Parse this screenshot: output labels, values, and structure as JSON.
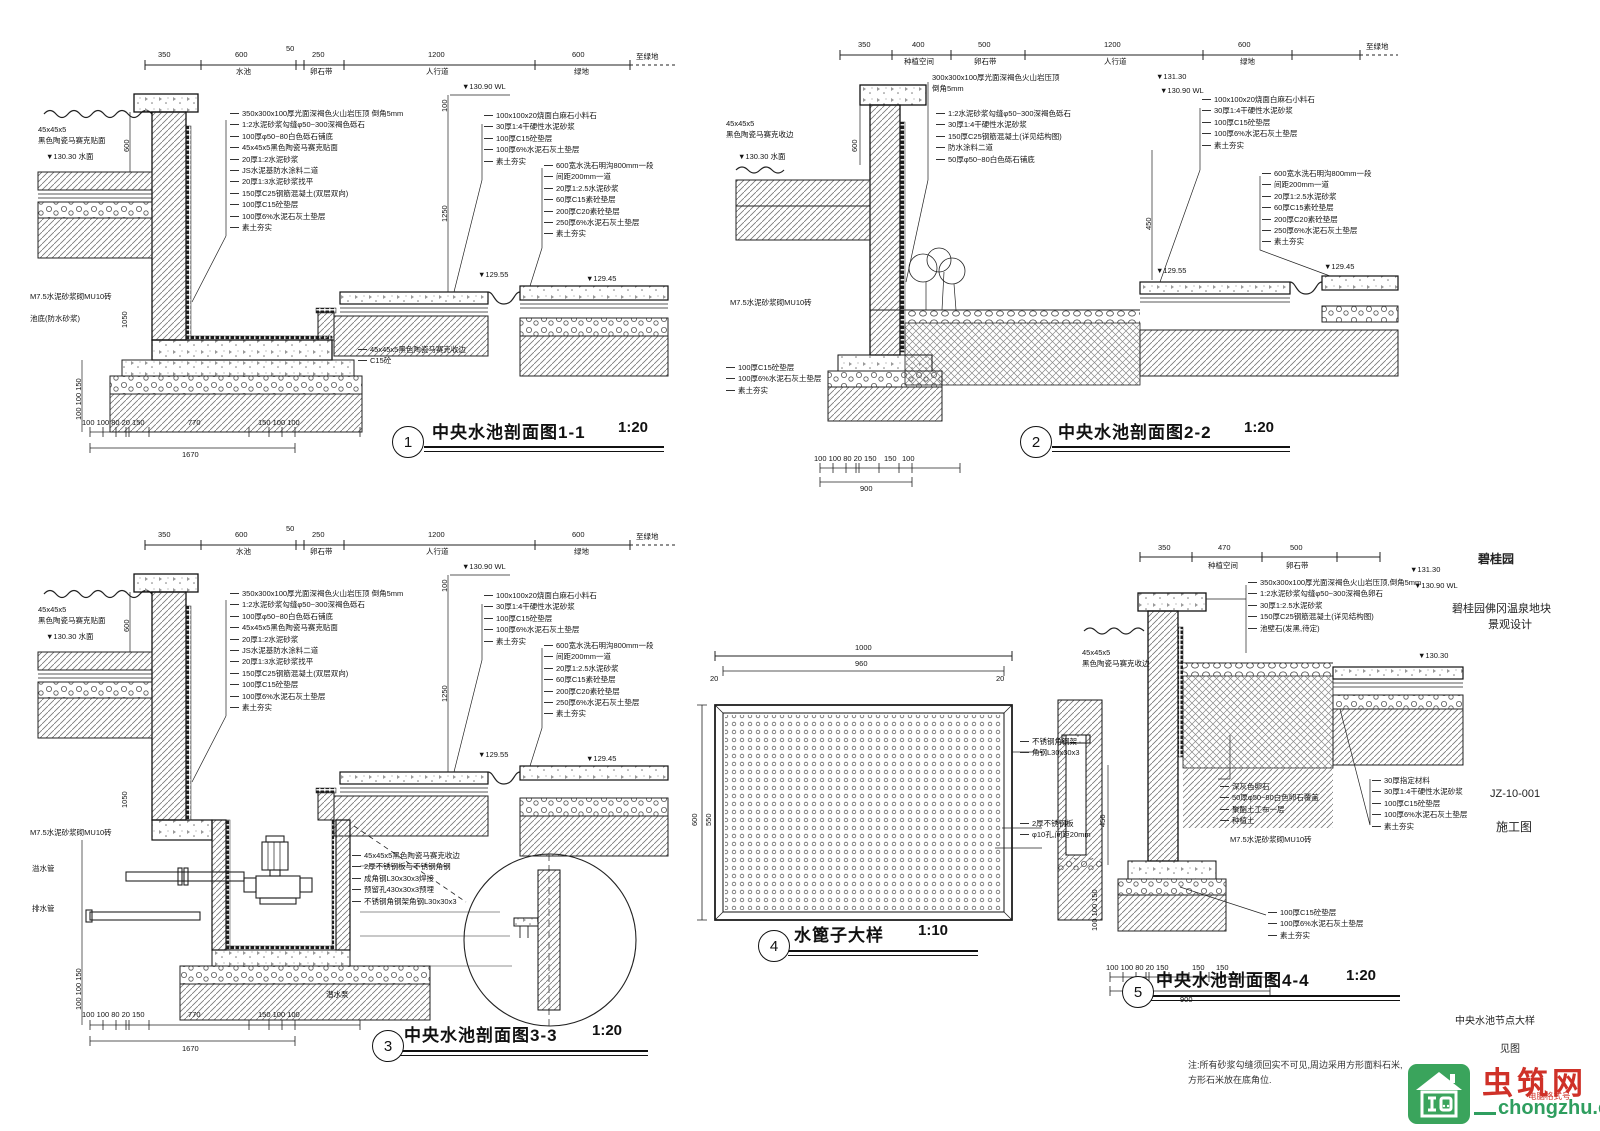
{
  "details": {
    "d1": {
      "num": "1",
      "name": "中央水池剖面图1-1",
      "scale": "1:20",
      "dims_top": [
        "350",
        "600",
        "50",
        "250",
        "1200",
        "600"
      ],
      "seg_labels": [
        "水池",
        "卵石带",
        "人行道",
        "绿地"
      ],
      "tail": "至绿地",
      "elev_wl": "▼130.90 WL",
      "elev_water": "▼130.30 水面",
      "elev_p1": "▼129.55",
      "elev_p2": "▼129.45",
      "v600": "600",
      "v100": "100",
      "v1250": "1250",
      "v1050": "1050",
      "vstack": "100 100 150",
      "notes_left": [
        "45x45x5",
        "黑色陶瓷马赛克贴面"
      ],
      "note_m75": "M7.5水泥砂浆砌MU10砖",
      "note_pool_bottom": "池底(防水砂浆)",
      "notes_center": [
        "350x300x100厚光面深褐色火山岩压顶 倒角5mm",
        "1:2水泥砂浆勾缝φ50~300深褐色砾石",
        "100厚φ50~80白色砾石铺底",
        "45x45x5黑色陶瓷马赛克贴面",
        "20厚1:2水泥砂浆",
        "JS水泥基防水涂料二道",
        "20厚1:3水泥砂浆找平",
        "150厚C25钢筋混凝土(双层双向)",
        "100厚C15砼垫层",
        "100厚6%水泥石灰土垫层",
        "素土夯实"
      ],
      "notes_edge": [
        "45x45x5黑色陶瓷马赛克收边",
        "C15砼"
      ],
      "notes_right_top": [
        "100x100x20烧面白麻石小料石",
        "30厚1:4干硬性水泥砂浆",
        "100厚C15砼垫层",
        "100厚6%水泥石灰土垫层",
        "素土夯实"
      ],
      "notes_right_sub": [
        "600宽水洗石明沟800mm一段",
        "间距200mm一道",
        "20厚1:2.5水泥砂浆",
        "60厚C15素砼垫层",
        "200厚C20素砼垫层",
        "250厚6%水泥石灰土垫层",
        "素土夯实"
      ],
      "dims_bottom": [
        "100 100 80 20 150",
        "770",
        "150 100 100"
      ],
      "dim_total": "1670"
    },
    "d2": {
      "num": "2",
      "name": "中央水池剖面图2-2",
      "scale": "1:20",
      "dims_top": [
        "350",
        "400",
        "500",
        "1200",
        "600"
      ],
      "seg_labels": [
        "种植空间",
        "卵石带",
        "人行道",
        "绿地"
      ],
      "tail": "至绿地",
      "elev_1": "▼131.30",
      "elev_wl": "▼130.90 WL",
      "elev_water": "▼130.30 水面",
      "elev_p1": "▼129.55",
      "elev_p2": "▼129.45",
      "v600": "600",
      "v450": "450",
      "notes_top": [
        "300x300x100厚光面深褐色火山岩压顶",
        "倒角5mm"
      ],
      "notes_center": [
        "1:2水泥砂浆勾缝φ50~300深褐色砾石",
        "30厚1:4干硬性水泥砂浆",
        "150厚C25钢筋混凝土(详见结构图)",
        "防水涂料二道",
        "50厚φ50~80白色砾石铺底"
      ],
      "notes_left": [
        "45x45x5",
        "黑色陶瓷马赛克收边"
      ],
      "note_m75": "M7.5水泥砂浆砌MU10砖",
      "notes_base": [
        "100厚C15砼垫层",
        "100厚6%水泥石灰土垫层",
        "素土夯实"
      ],
      "notes_right_top": [
        "100x100x20烧面白麻石小料石",
        "30厚1:4干硬性水泥砂浆",
        "100厚C15砼垫层",
        "100厚6%水泥石灰土垫层",
        "素土夯实"
      ],
      "notes_right_sub": [
        "600宽水洗石明沟800mm一段",
        "间距200mm一道",
        "20厚1:2.5水泥砂浆",
        "60厚C15素砼垫层",
        "200厚C20素砼垫层",
        "250厚6%水泥石灰土垫层",
        "素土夯实"
      ],
      "dims_bottom": [
        "100 100 80 20 150",
        "150",
        "100"
      ],
      "dim_total": "900"
    },
    "d3": {
      "num": "3",
      "name": "中央水池剖面图3-3",
      "scale": "1:20",
      "dims_top": [
        "350",
        "600",
        "50",
        "250",
        "1200",
        "600"
      ],
      "seg_labels": [
        "水池",
        "卵石带",
        "人行道",
        "绿地"
      ],
      "tail": "至绿地",
      "elev_wl": "▼130.90 WL",
      "elev_water": "▼130.30 水面",
      "elev_p1": "▼129.55",
      "elev_p2": "▼129.45",
      "v600": "600",
      "v100": "100",
      "v1250": "1250",
      "v1050": "1050",
      "vstack": "100 100 150",
      "notes_left": [
        "45x45x5",
        "黑色陶瓷马赛克贴面"
      ],
      "note_m75": "M7.5水泥砂浆砌MU10砖",
      "pipe1": "溢水管",
      "pipe2": "排水管",
      "pump_label": "潜水泵",
      "notes_center": [
        "350x300x100厚光面深褐色火山岩压顶 倒角5mm",
        "1:2水泥砂浆勾缝φ50~300深褐色砾石",
        "100厚φ50~80白色砾石铺底",
        "45x45x5黑色陶瓷马赛克贴面",
        "20厚1:2水泥砂浆",
        "JS水泥基防水涂料二道",
        "20厚1:3水泥砂浆找平",
        "150厚C25钢筋混凝土(双层双向)",
        "100厚C15砼垫层",
        "100厚6%水泥石灰土垫层",
        "素土夯实"
      ],
      "notes_detail": [
        "45x45x5黑色陶瓷马赛克收边",
        "2厚不锈钢板与不锈钢角钢",
        "成角钢L30x30x3焊接",
        "预留孔430x30x3预埋",
        "不锈钢角钢架角钢L30x30x3"
      ],
      "notes_right_top": [
        "100x100x20烧面白麻石小料石",
        "30厚1:4干硬性水泥砂浆",
        "100厚C15砼垫层",
        "100厚6%水泥石灰土垫层",
        "素土夯实"
      ],
      "notes_right_sub": [
        "600宽水洗石明沟800mm一段",
        "间距200mm一道",
        "20厚1:2.5水泥砂浆",
        "60厚C15素砼垫层",
        "200厚C20素砼垫层",
        "250厚6%水泥石灰土垫层",
        "素土夯实"
      ],
      "dims_bottom": [
        "100 100 80 20 150",
        "770",
        "150 100 100"
      ],
      "dim_total": "1670"
    },
    "d4": {
      "num": "4",
      "name": "水篦子大样",
      "scale": "1:10",
      "dim_1000": "1000",
      "dim_960": "960",
      "edge_l": "20",
      "edge_r": "20",
      "side_600": "600",
      "side_550": "550",
      "notes_frame": [
        "不锈钢角钢架",
        "角钢L30x30x3"
      ],
      "notes_plate": [
        "2厚不锈钢板",
        "φ10孔,间距20mm"
      ]
    },
    "d5": {
      "num": "5",
      "name": "中央水池剖面图4-4",
      "scale": "1:20",
      "dims_top": [
        "350",
        "470",
        "500"
      ],
      "seg_labels": [
        "种植空间",
        "卵石带"
      ],
      "elev_1": "▼131.30",
      "elev_wl": "▼130.90 WL",
      "elev_2": "▼130.30",
      "v450": "450",
      "vstack": "100 100 150",
      "notes_top": [
        "350x300x100厚光面深褐色火山岩压顶,倒角5mm",
        "1:2水泥砂浆勾缝φ50~300深褐色卵石",
        "30厚1:2.5水泥砂浆",
        "150厚C25钢筋混凝土(详见结构图)",
        "池壁石(发黑,待定)"
      ],
      "notes_left": [
        "45x45x5",
        "黑色陶瓷马赛克收边"
      ],
      "notes_mid": [
        "深灰色卵石",
        "50厚φ50~80白色卵石覆盖",
        "聚酯土工布一层",
        "种植土"
      ],
      "note_m75": "M7.5水泥砂浆砌MU10砖",
      "notes_right": [
        "30厚指定材料",
        "30厚1:4干硬性水泥砂浆",
        "100厚C15砼垫层",
        "100厚6%水泥石灰土垫层",
        "素土夯实"
      ],
      "notes_base": [
        "100厚C15砼垫层",
        "100厚6%水泥石灰土垫层",
        "素土夯实"
      ],
      "dims_bottom": [
        "100 100 80 20 150",
        "150",
        "150"
      ],
      "dim_total": "900"
    }
  },
  "margin": {
    "brand": "碧桂园",
    "project_line1": "碧桂园佛冈温泉地块",
    "project_line2": "景观设计",
    "drawing_no": "JZ-10-001",
    "doc_type": "施工图",
    "sheet_name": "中央水池节点大样",
    "sheet_ref": "见图"
  },
  "footnote": {
    "line1": "注:所有砂浆勾缝须回实不可见,周边采用方形面料石米,",
    "line2": "方形石米放在底角位."
  },
  "watermark": {
    "site_name": "虫筑网",
    "tagline": "电脑格式号",
    "site_url": "chongzhu.cn"
  }
}
